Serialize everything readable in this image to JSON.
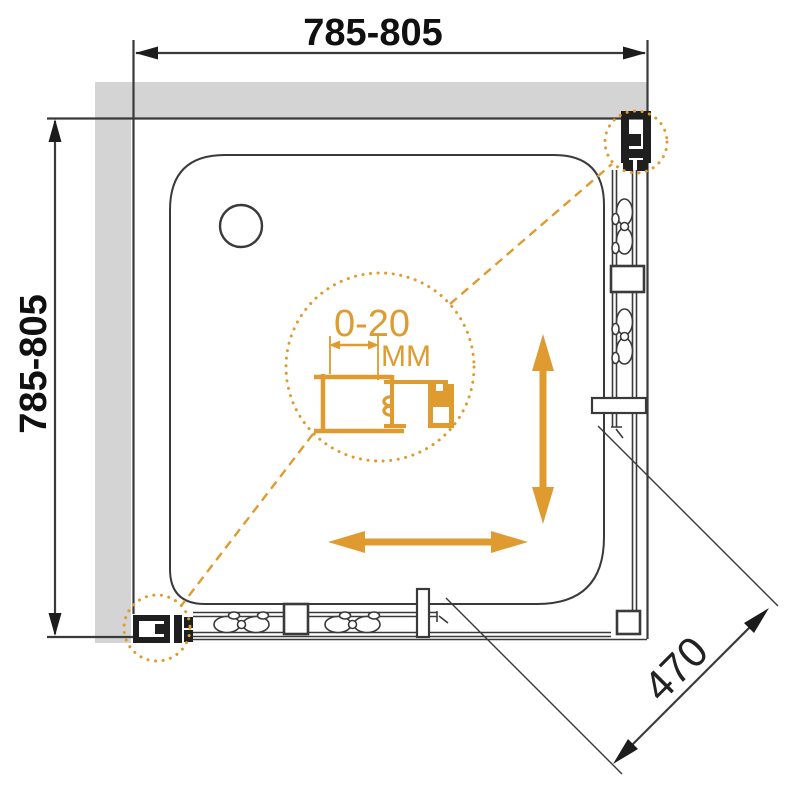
{
  "diagram": {
    "title": "corner shower enclosure plan drawing",
    "dimensions": {
      "top_width": "785-805",
      "left_depth": "785-805",
      "entry_diagonal": "470"
    },
    "adjustment_detail": {
      "range": "0-20",
      "unit": "MM"
    },
    "colors": {
      "accent": "#DF9B2F",
      "wall": "#D4D4D4",
      "line": "#3A3A3A",
      "black": "#1F1F1F"
    }
  }
}
